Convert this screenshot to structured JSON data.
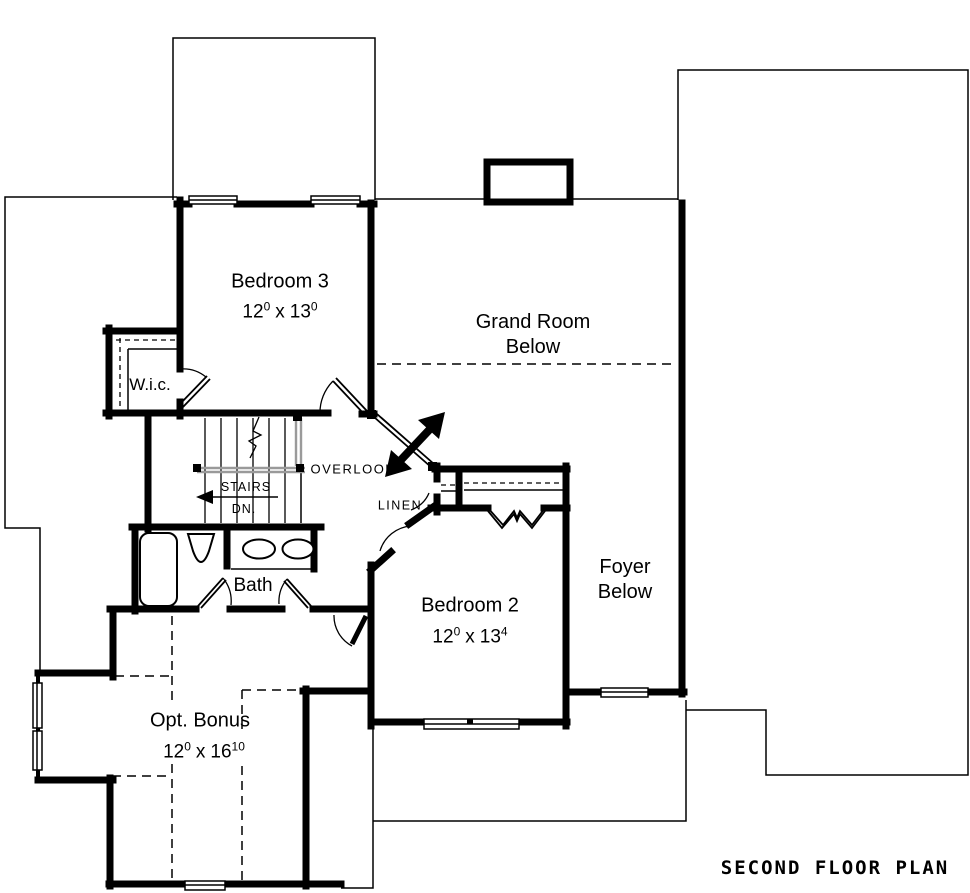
{
  "title": "SECOND FLOOR PLAN",
  "colors": {
    "ink": "#000000",
    "railing": "#9a9a9a",
    "paper": "#ffffff"
  },
  "rooms": {
    "bedroom3": {
      "name": "Bedroom 3",
      "w": "12",
      "w_sup": "0",
      "sep": "x",
      "h": "13",
      "h_sup": "0"
    },
    "bedroom2": {
      "name": "Bedroom 2",
      "w": "12",
      "w_sup": "0",
      "sep": "x",
      "h": "13",
      "h_sup": "4"
    },
    "bonus": {
      "name": "Opt. Bonus",
      "w": "12",
      "w_sup": "0",
      "sep": "x",
      "h": "16",
      "h_sup": "10"
    },
    "wic": {
      "name": "W.i.c."
    },
    "bath": {
      "name": "Bath"
    },
    "grand_room": {
      "line1": "Grand Room",
      "line2": "Below"
    },
    "foyer": {
      "line1": "Foyer",
      "line2": "Below"
    },
    "overlook": {
      "label": "OVERLOOK"
    },
    "linen": {
      "label": "LINEN"
    },
    "stairs": {
      "label": "STAIRS",
      "direction": "DN."
    }
  }
}
